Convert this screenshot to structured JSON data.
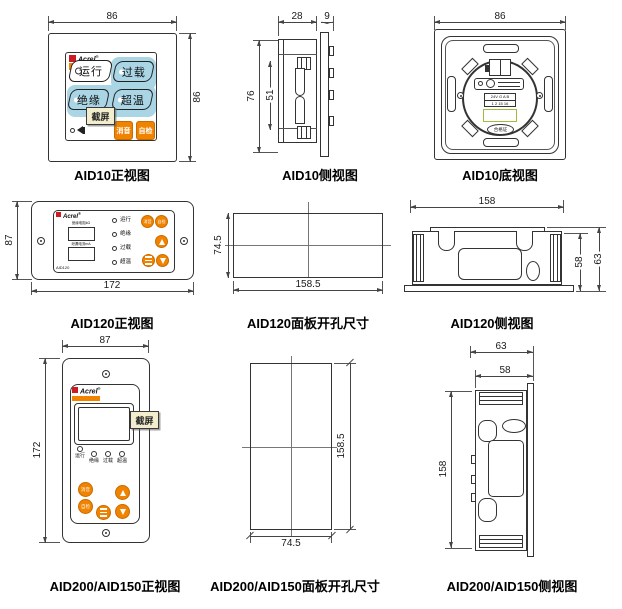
{
  "p1": {
    "cap": "AID10正视图",
    "dim_top": "86",
    "dim_right": "86",
    "brand": "Acrel",
    "reg": "®",
    "model": "AID10",
    "run": "运行",
    "overload": "过载",
    "insulation": "绝缘",
    "overtemp": "超温",
    "mute": "消音",
    "selftest": "自检",
    "tooltip": "截屏"
  },
  "p2": {
    "cap": "AID10侧视图",
    "dim_depth": "28",
    "dim_plate": "9",
    "dim_h": "76",
    "dim_inner": "51"
  },
  "p3": {
    "cap": "AID10底视图",
    "dim_top": "86",
    "term1": "24V G A B",
    "term2": "1 2 15 16",
    "cert": "合格证"
  },
  "p4": {
    "cap": "AID120正视图",
    "dim_h": "87",
    "dim_w": "172",
    "brand": "Acrel",
    "reg": "®",
    "model": "AID120",
    "disp1": "绝缘电阻kΩ",
    "disp2": "泄漏电流mA",
    "led1": "运行",
    "led2": "绝缘",
    "led3": "过载",
    "led4": "超温",
    "mute": "消音",
    "selftest": "自检"
  },
  "p5": {
    "cap": "AID120面板开孔尺寸",
    "dim_h": "74.5",
    "dim_w": "158.5"
  },
  "p6": {
    "cap": "AID120侧视图",
    "dim_w": "158",
    "dim_h1": "58",
    "dim_h2": "63"
  },
  "p7": {
    "cap": "AID200/AID150正视图",
    "dim_w": "87",
    "dim_h": "172",
    "brand": "Acrel",
    "reg": "®",
    "led1": "运行",
    "led2": "绝缘",
    "led3": "过载",
    "led4": "超温",
    "mute": "消音",
    "selftest": "自检",
    "tooltip": "截屏"
  },
  "p8": {
    "cap": "AID200/AID150面板开孔尺寸",
    "dim_w": "74.5",
    "dim_h": "158.5"
  },
  "p9": {
    "cap": "AID200/AID150侧视图",
    "dim_d1": "63",
    "dim_d2": "58",
    "dim_h": "158"
  },
  "colors": {
    "accent_orange": "#F08300",
    "indicator_blue": "#A9D5E5",
    "logo_red": "#CE1B23",
    "tooltip_bg": "#F2EDCC",
    "cert_green": "#9BBF3B"
  }
}
